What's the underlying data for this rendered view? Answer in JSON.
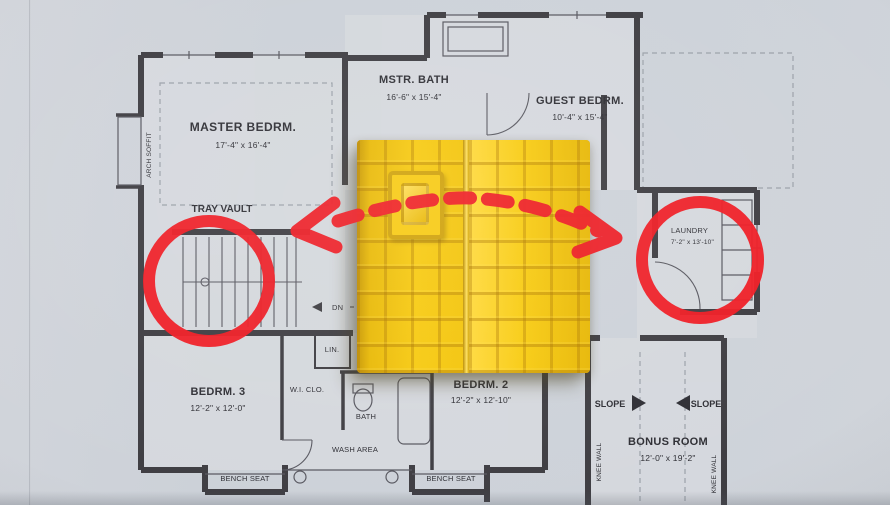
{
  "plan": {
    "rooms": {
      "master_bedroom": {
        "label": "MASTER BEDRM.",
        "dims": "17'-4\" x 16'-4\""
      },
      "master_bath": {
        "label": "MSTR. BATH",
        "dims": "16'-6\" x 15'-4\""
      },
      "guest_bedroom": {
        "label": "GUEST BEDRM.",
        "dims": "10'-4\" x 15'-4\""
      },
      "laundry": {
        "label": "LAUNDRY",
        "dims": "7'-2\" x 13'-10\""
      },
      "bedroom_3": {
        "label": "BEDRM. 3",
        "dims": "12'-2\" x 12'-0\""
      },
      "bedroom_2": {
        "label": "BEDRM. 2",
        "dims": "12'-2\" x 12'-10\""
      },
      "bonus_room": {
        "label": "BONUS ROOM",
        "dims": "12'-0\" x 19'-2\""
      }
    },
    "annotations": {
      "tray_vault": "TRAY VAULT",
      "arch_soffit": "ARCH SOFFIT",
      "dn": "DN",
      "lin": "LIN.",
      "wi_closet": "W.I. CLO.",
      "bath": "BATH",
      "wash_area": "WASH AREA",
      "bench_seat_left": "BENCH SEAT",
      "bench_seat_right": "BENCH SEAT",
      "knee_wall_left": "KNEE WALL",
      "knee_wall_right": "KNEE WALL",
      "slope_left": "SLOPE",
      "slope_right": "SLOPE"
    }
  },
  "overlay": {
    "annotation_red": "#ee1b23",
    "house_yellow": "#f2c307"
  }
}
